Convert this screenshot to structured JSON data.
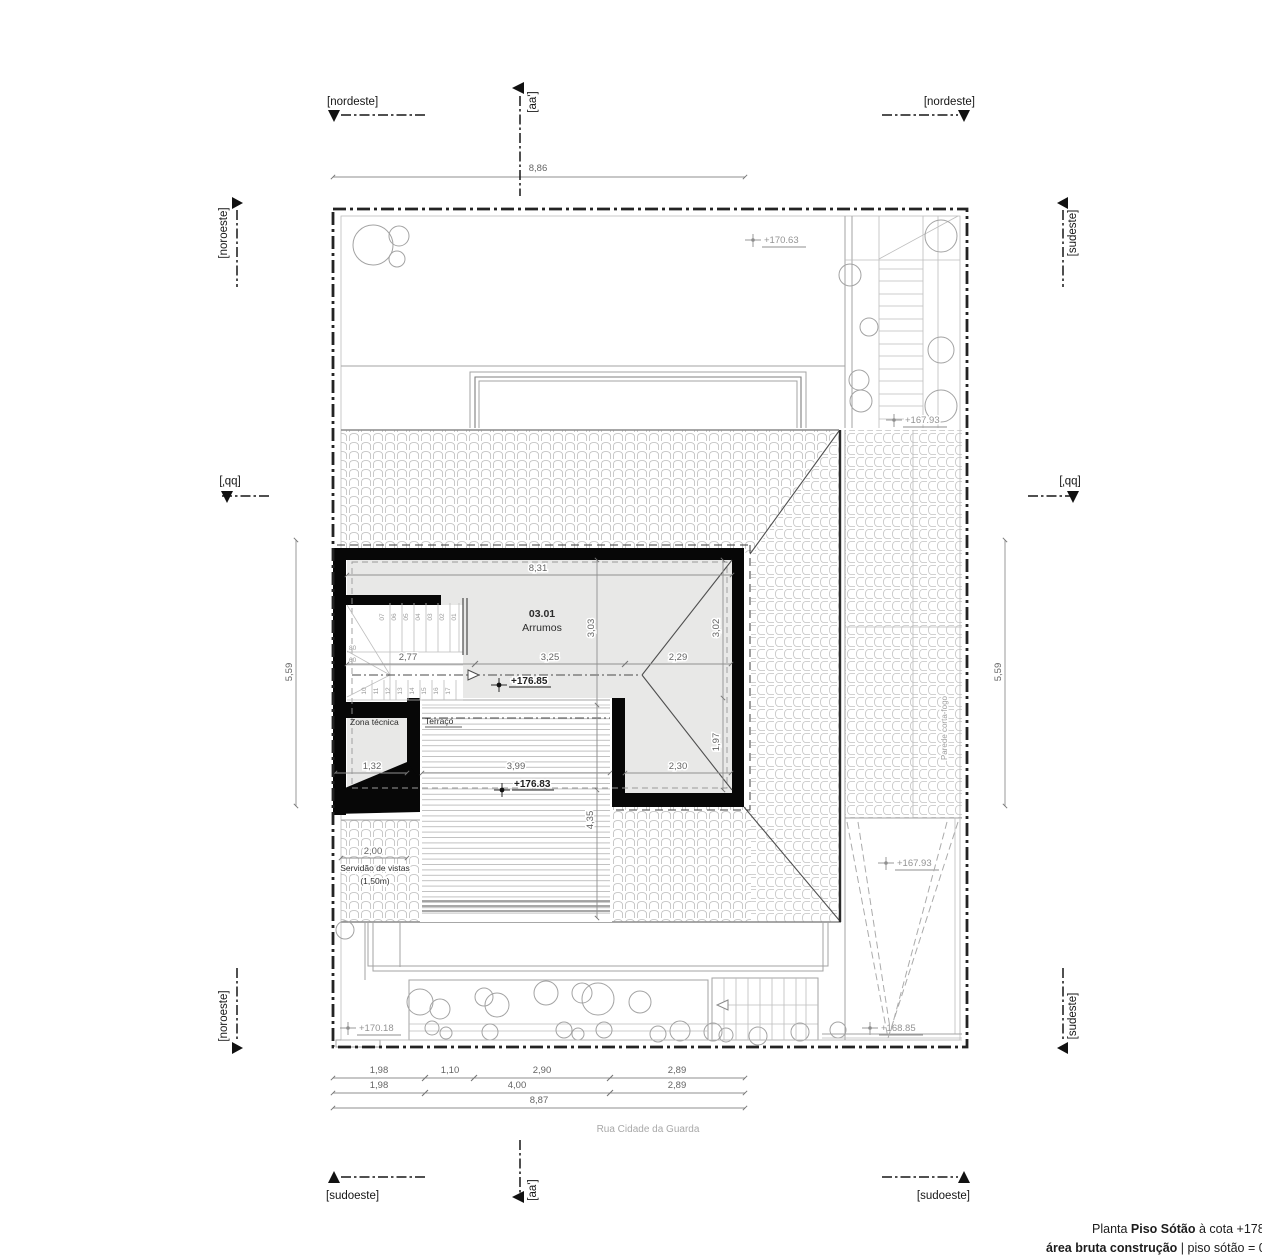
{
  "section_markers": {
    "nordeste_left": "[nordeste]",
    "nordeste_right": "[nordeste]",
    "sudoeste_left": "[sudoeste]",
    "sudoeste_right": "[sudoeste]",
    "noroeste_top": "[noroeste]",
    "noroeste_bottom": "[noroeste]",
    "sudeste_top": "[sudeste]",
    "sudeste_bottom": "[sudeste]",
    "aa_top": "[aa']",
    "aa_bottom": "[aa']",
    "bb_left": "[bb']",
    "bb_right": "[bb']"
  },
  "dimensions": {
    "top_width": "8,86",
    "side_left": "5,59",
    "side_right": "5,59",
    "room_width": "8,31",
    "room_height_left": "3,03",
    "room_height_right": "3,02",
    "stair_run": "2,77",
    "room_mid": "3,25",
    "room_right": "2,29",
    "zona_width": "1,32",
    "terrace_width": "3,99",
    "terrace_depth": "4,35",
    "right_low_width": "2,30",
    "right_low_height": "1,97",
    "servidao_width": "2,00",
    "stair_80": "80",
    "stair_60": "60",
    "chain1": [
      "1,98",
      "1,10",
      "2,90",
      "2,89"
    ],
    "chain2": [
      "1,98",
      "4,00",
      "2,89"
    ],
    "chain3": "8,87"
  },
  "elevations": {
    "garden_top": "+170.63",
    "stair_top": "+167.93",
    "attic_floor": "+176.85",
    "terrace_floor": "+176.83",
    "roof_right": "+167.93",
    "garden_bottom_left": "+170.18",
    "garden_bottom_right": "+168.85"
  },
  "rooms": {
    "number": "03.01",
    "name": "Arrumos",
    "zona_tecnica": "Zona técnica",
    "terraco": "Terraço"
  },
  "stair": {
    "upper_steps": [
      "07",
      "06",
      "05",
      "04",
      "03",
      "02",
      "01"
    ],
    "lower_steps": [
      "10",
      "11",
      "12",
      "13",
      "14",
      "15",
      "16",
      "17"
    ]
  },
  "notes": {
    "servidao_line1": "Servidão de vistas",
    "servidao_line2": "(1,50m)",
    "firewall": "Parede corta-fogo",
    "street": "Rua Cidade da Guarda"
  },
  "titleblock": {
    "l1_prefix": "Planta ",
    "l1_bold": "Piso Sótão",
    "l1_suffix": " à cota +178",
    "l2_bold": "área bruta construção",
    "l2_rest": " | piso sótão = 031"
  }
}
